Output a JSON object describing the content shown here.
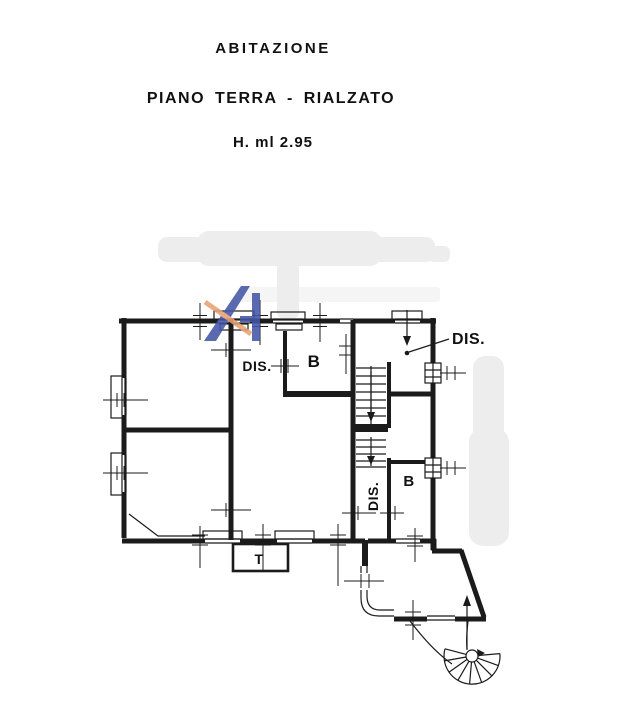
{
  "header": {
    "title": "ABITAZIONE",
    "subtitle": "PIANO TERRA - RIALZATO",
    "height_note": "H. ml 2.95"
  },
  "floorplan": {
    "labels": {
      "dis_top_left": "DIS.",
      "bath_top": "B",
      "dis_top_right": "DIS.",
      "dis_stair": "DIS.",
      "bath_right": "B",
      "terrace": "T"
    }
  },
  "colors": {
    "wall": "#1b1b1b",
    "text": "#111111",
    "paper": "#ffffff",
    "watermark_gray": "#ededed",
    "logo_blue": "#4456a6",
    "logo_orange": "#e8a272"
  }
}
